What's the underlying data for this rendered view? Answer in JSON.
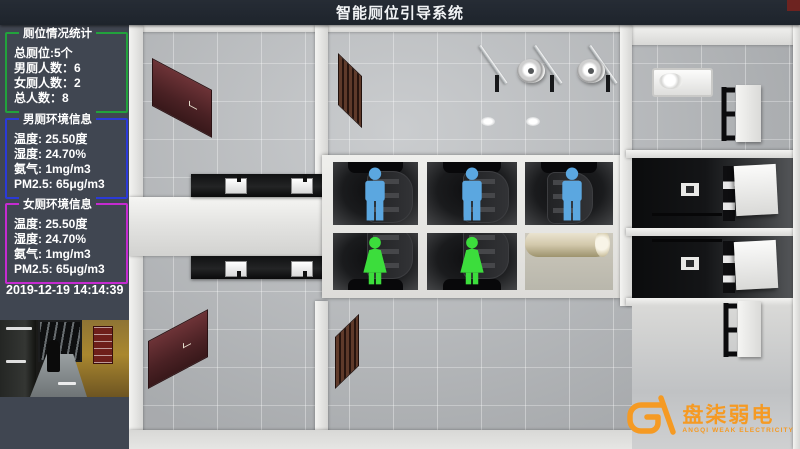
{
  "title": "智能厕位引导系统",
  "sidebar": {
    "stats_panel": {
      "title": "厕位情况统计",
      "border_color": "#22a23c",
      "lines": [
        "总厕位:5个",
        "男厕人数：6",
        "女厕人数：2",
        "总人数：8"
      ]
    },
    "male_env_panel": {
      "title": "男厕环境信息",
      "border_color": "#2b3ad8",
      "lines": [
        "温度: 25.50度",
        "湿度: 24.70%",
        "氨气: 1mg/m3",
        "PM2.5: 65μg/m3"
      ]
    },
    "female_env_panel": {
      "title": "女厕环境信息",
      "border_color": "#c52bd0",
      "lines": [
        "温度: 25.50度",
        "湿度: 24.70%",
        "氨气: 1mg/m3",
        "PM2.5: 65μg/m3"
      ]
    },
    "timestamp": "2019-12-19 14:14:39"
  },
  "scene": {
    "stalls": [
      {
        "row": "top",
        "index": 1,
        "occupant": "male",
        "indicator_color": "#5ba7e0"
      },
      {
        "row": "top",
        "index": 2,
        "occupant": "male",
        "indicator_color": "#5ba7e0"
      },
      {
        "row": "top",
        "index": 3,
        "occupant": "male",
        "indicator_color": "#5ba7e0"
      },
      {
        "row": "bottom",
        "index": 1,
        "occupant": "female",
        "indicator_color": "#3cdd3c"
      },
      {
        "row": "bottom",
        "index": 2,
        "occupant": "female",
        "indicator_color": "#3cdd3c"
      }
    ]
  },
  "logo": {
    "name": "盘柒弱电",
    "subtitle": "ANGQI WEAK ELECTRICITY",
    "color": "#f59a23"
  }
}
